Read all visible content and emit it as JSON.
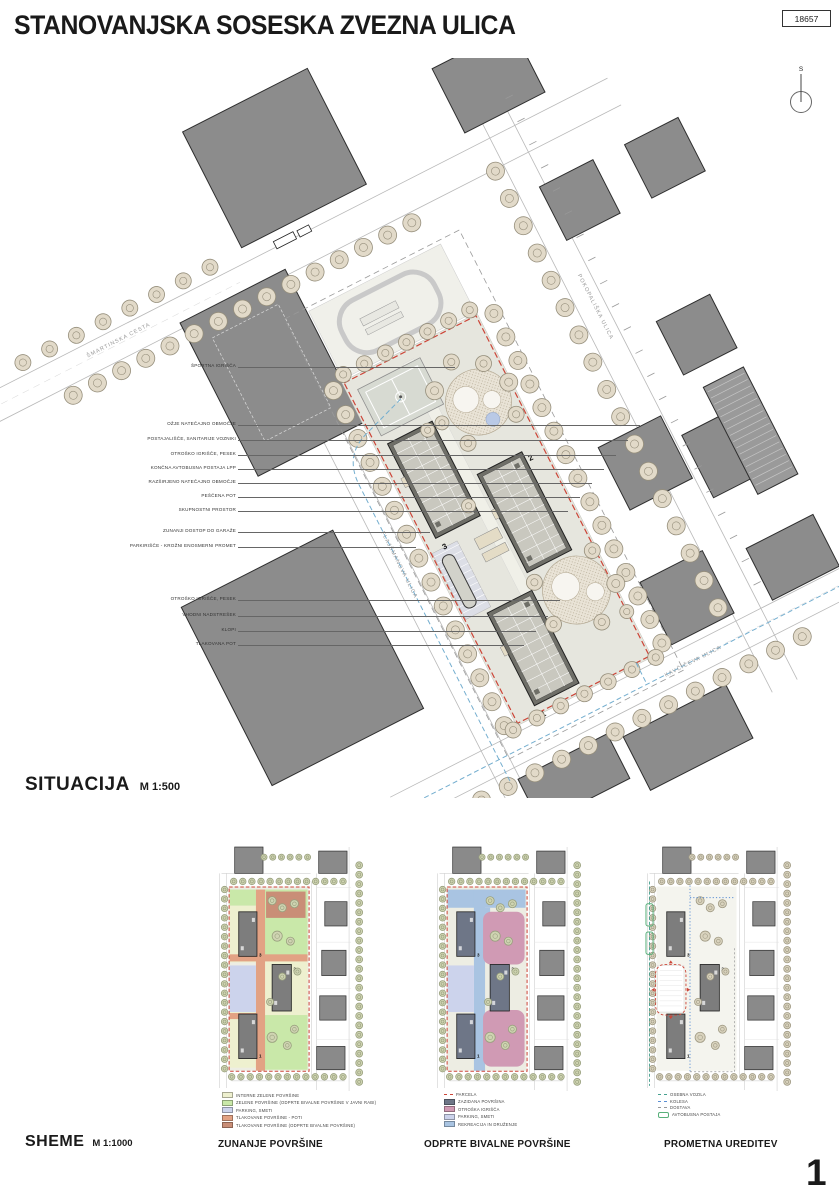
{
  "meta": {
    "title": "STANOVANJSKA SOSESKA ZVEZNA ULICA",
    "sheet_number": "18657",
    "page_number": "1"
  },
  "colors": {
    "parcel_red": "#cc4538",
    "route_blue": "#74aecf",
    "building_gray": "#8c8c8c",
    "tree_beige": "#e2dac9",
    "tree_green": "#cfd4b2"
  },
  "situacija": {
    "label": "SITUACIJA",
    "scale": "M 1:500",
    "north_label": "S",
    "building_numbers": [
      "1",
      "2",
      "3"
    ],
    "streets": {
      "smartinska": "ŠMARTINSKA CESTA",
      "flajsmanova": "FLAJŠMANOVA ULICA",
      "pokopaliska": "POKOPALIŠKA ULICA",
      "kavciceva": "KAVČIČEVA ULICA"
    },
    "callouts": [
      "ŠPORTNA IGRIŠČA",
      "OŽJE NATEČAJNO OBMOČJE",
      "POSTAJALIŠČE, SANITARIJE VOZNIKI",
      "OTROŠKO IGRIŠČE, PESEK",
      "KONČNA AVTOBUSNA POSTAJA LPP",
      "RAZŠIRJENO NATEČAJNO OBMOČJE",
      "PEŠČENA POT",
      "SKUPNOSTNI PROSTOR",
      "ZUNANJI DOSTOP DO GARAŽE",
      "PARKIRIŠČE - KROŽNI ENOSMERNI PROMET",
      "OTROŠKO IGRIŠČE, PESEK",
      "VHODNI NADSTREŠEK",
      "KLOPI",
      "TLAKOVANA POT"
    ]
  },
  "sheme": {
    "label": "SHEME",
    "scale": "M 1:1000",
    "schemes": [
      {
        "title": "ZUNANJE POVRŠINE",
        "legend": [
          {
            "type": "fill",
            "color": "#eef0cf",
            "label": "INTERNE ZELENE POVRŠINE"
          },
          {
            "type": "fill",
            "color": "#c9e8a9",
            "label": "ZELENE POVRŠINE (ODPRTE BIVALNE POVRŠINE V JAVNI RABI)"
          },
          {
            "type": "fill",
            "color": "#ccd3ec",
            "label": "PARKING, SMETI"
          },
          {
            "type": "fill",
            "color": "#e2a284",
            "label": "TLAKOVANE POVRŠINE - POTI"
          },
          {
            "type": "fill",
            "color": "#c98e77",
            "label": "TLAKOVANE POVRŠINE (ODPRTE BIVALNE POVRŠINE)"
          }
        ]
      },
      {
        "title": "ODPRTE BIVALNE POVRŠINE",
        "legend": [
          {
            "type": "dash",
            "color": "#cc4538",
            "label": "PARCELA"
          },
          {
            "type": "fill",
            "color": "#6e7687",
            "label": "ZAZIDANA POVRŠINA"
          },
          {
            "type": "fill",
            "color": "#d09ab4",
            "label": "OTROŠKA IGRIŠČA"
          },
          {
            "type": "fill",
            "color": "#ccd3ec",
            "label": "PARKING, SMETI"
          },
          {
            "type": "fill",
            "color": "#a9c4e2",
            "label": "REKREACIJA IN DRUŽENJE"
          }
        ]
      },
      {
        "title": "PROMETNA UREDITEV",
        "legend": [
          {
            "type": "dash",
            "color": "#46a08f",
            "label": "OSEBNA VOZILA"
          },
          {
            "type": "dash",
            "color": "#5b8fd4",
            "label": "KOLESA"
          },
          {
            "type": "dash",
            "color": "#999999",
            "label": "DOSTAVA"
          },
          {
            "type": "outline",
            "color": "#59b07a",
            "label": "AVTOBUSNA POSTAJA"
          }
        ]
      }
    ]
  }
}
